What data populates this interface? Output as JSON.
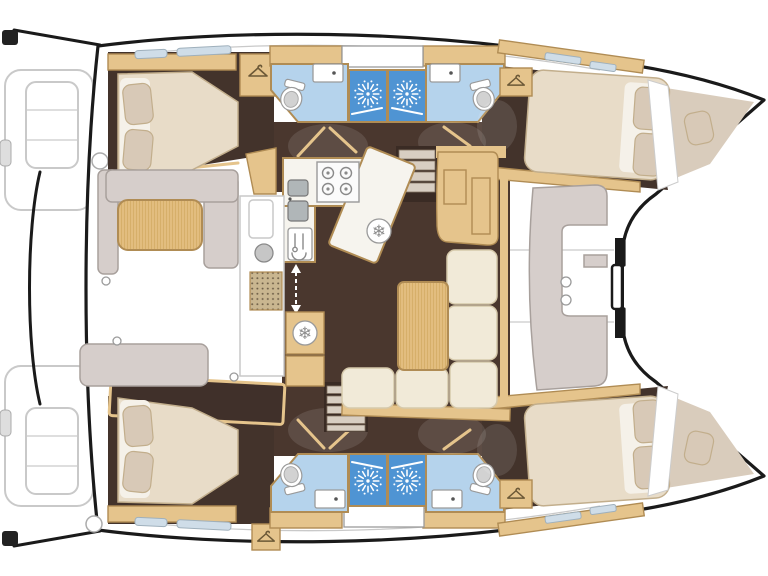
{
  "meta": {
    "title": "Catamaran interior layout floor plan",
    "view": "overhead accommodation plan, bow to the right, stern to the left",
    "image_type": "illustrated yacht deck plan, no text labels visible"
  },
  "colors": {
    "outline": "#1a1a1a",
    "deck": "#ffffff",
    "deck_line": "#c9c9c9",
    "floor_dark": "#4a372e",
    "floor_dark2": "#43332b",
    "wood": "#e5c48c",
    "wood_dark": "#b08c54",
    "counter": "#f6f4ee",
    "mattress": "#e8dcc8",
    "mattress_edge": "#c2ae8c",
    "sheet": "#f5f1e9",
    "pillow": "#d8c9b7",
    "cushion_gray": "#d6cecb",
    "cushion_edge": "#a8a09c",
    "sofa_cream": "#f1ead8",
    "sofa_edge": "#d6c9ab",
    "bath_floor": "#b5d3ec",
    "shower_blue": "#4f94d3",
    "hatch": "#cfdde8",
    "hatch_edge": "#9fb0bc",
    "grate": "#c9b690",
    "grate_dot": "#6f5f48",
    "step": "#d8cec2",
    "fixture_stroke": "#9a9a9a",
    "seat_gray": "#d2d2d2",
    "dark_panel": "#40302a"
  },
  "glyphs": {
    "snowflake": "❄"
  },
  "icon_names": [
    "shower-sunburst-icon",
    "coat-hanger-icon",
    "toilet-icon",
    "sink-icon",
    "stove-burners-icon",
    "fridge-snowflake-icon",
    "utensils-icon",
    "sliding-door-arrow-icon",
    "floor-grate-icon",
    "deck-hatch-icon"
  ],
  "rooms": [
    {
      "id": "cockpit",
      "label": "Aft cockpit with teak table and bench seating"
    },
    {
      "id": "saloon",
      "label": "Saloon with U-shaped sofa and table"
    },
    {
      "id": "galley",
      "label": "Galley with 4-burner stove, double sink, fridges"
    },
    {
      "id": "nav-station",
      "label": "Navigation console"
    },
    {
      "id": "port-aft-cabin",
      "label": "Port aft double cabin"
    },
    {
      "id": "port-forward-cabin",
      "label": "Port forward double cabin"
    },
    {
      "id": "starboard-aft-cabin",
      "label": "Starboard aft double cabin"
    },
    {
      "id": "starboard-forward-cabin",
      "label": "Starboard forward double cabin"
    },
    {
      "id": "port-heads",
      "label": "Two port bathrooms with shower cubicles"
    },
    {
      "id": "starboard-heads",
      "label": "Two starboard bathrooms with shower cubicles"
    },
    {
      "id": "port-bow-berth",
      "label": "Port forepeak single berth"
    },
    {
      "id": "starboard-bow-berth",
      "label": "Starboard forepeak single berth"
    },
    {
      "id": "foredeck-lounge",
      "label": "Foredeck lounge seat"
    },
    {
      "id": "transom-steps",
      "label": "Twin transom swim steps"
    }
  ],
  "equipment_counts": {
    "double_cabins": 4,
    "bow_berths": 2,
    "bathrooms": 4,
    "shower_cubicles": 4,
    "toilets": 4,
    "bathroom_sinks": 4,
    "stove_burners": 4,
    "fridge_symbols": 2,
    "companionway_stairs": 2,
    "wardrobes_with_hanger": 4
  }
}
